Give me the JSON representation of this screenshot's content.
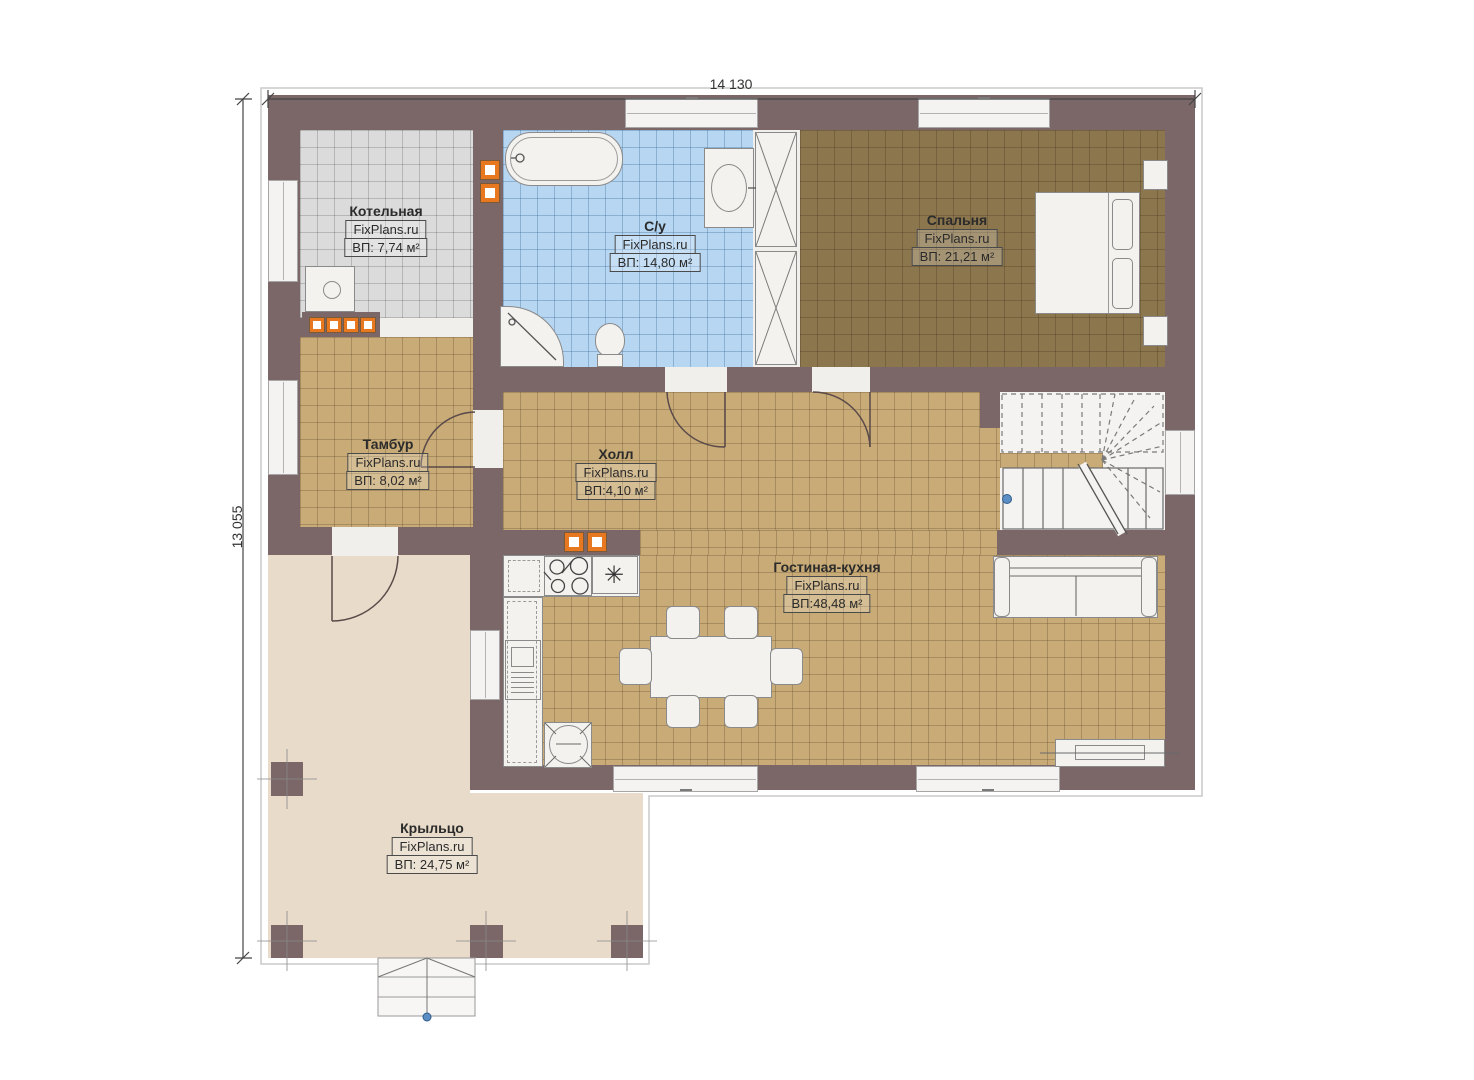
{
  "dimensions": {
    "width_label": "14 130",
    "height_label": "13 055"
  },
  "rooms": {
    "kotelnaya": {
      "name": "Котельная",
      "brand": "FixPlans.ru",
      "area": "ВП: 7,74 м²"
    },
    "su": {
      "name": "С/у",
      "brand": "FixPlans.ru",
      "area": "ВП: 14,80 м²"
    },
    "spalnya": {
      "name": "Спальня",
      "brand": "FixPlans.ru",
      "area": "ВП: 21,21 м²"
    },
    "tambur": {
      "name": "Тамбур",
      "brand": "FixPlans.ru",
      "area": "ВП: 8,02 м²"
    },
    "holl": {
      "name": "Холл",
      "brand": "FixPlans.ru",
      "area": "ВП:4,10 м²"
    },
    "gostinaya": {
      "name": "Гостиная-кухня",
      "brand": "FixPlans.ru",
      "area": "ВП:48,48 м²"
    },
    "kryltso": {
      "name": "Крыльцо",
      "brand": "FixPlans.ru",
      "area": "ВП: 24,75 м²"
    }
  },
  "symbols": {
    "sink": "✳"
  },
  "colors": {
    "wall": "#7b6768",
    "tile_gray": "#dbdbdb",
    "tile_blue": "#b7d6f1",
    "tile_brown": "#8c764e",
    "tile_tan": "#c9ab77",
    "porch": "#e8dbc9",
    "vent_orange": "#e87820",
    "marker_blue": "#4a78b0"
  }
}
